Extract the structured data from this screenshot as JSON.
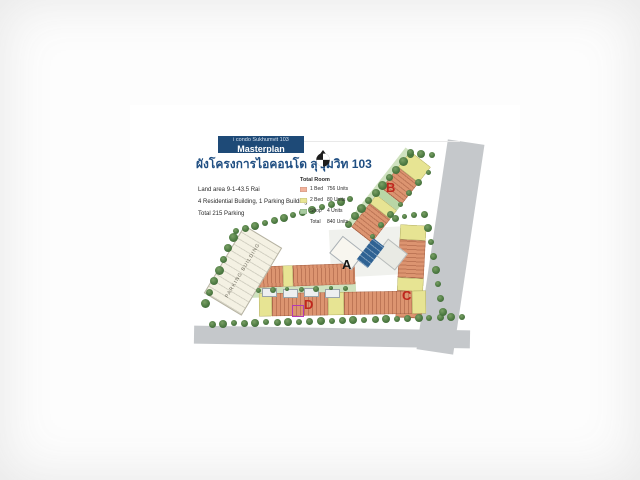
{
  "page": {
    "badge": {
      "project": "i condo Sukhumvit 103",
      "label": "Masterplan"
    },
    "title_thai": "ผังโครงการไอคอนโด สุขุมวิท 103",
    "info": {
      "land_area": "Land area 9-1-43.5 Rai",
      "buildings": "4 Residential Building, 1 Parking Building",
      "parking": "Total 215 Parking"
    },
    "legend": {
      "title": "Total Room",
      "rows": [
        {
          "label": "1 Bed",
          "value": "756 Units",
          "swatch": "#f2b29b"
        },
        {
          "label": "2 Bed",
          "value": "80 Units",
          "swatch": "#e9e694"
        },
        {
          "label": "Shop",
          "value": "4 Units",
          "swatch": "#a8cca0"
        },
        {
          "label": "Total",
          "value": "840 Units",
          "swatch": ""
        }
      ]
    },
    "plan": {
      "building_labels": {
        "a": "A",
        "b": "B",
        "c": "C",
        "d": "D"
      },
      "parking_label": "PARKING BUILDING",
      "north_icon": "north-arrow"
    },
    "colors": {
      "accent_blue": "#1e4a77",
      "title_blue": "#1f4e82",
      "building_salmon": "#dc9470",
      "unit_yellow": "#e7e493",
      "shop_green": "#a8cca0",
      "tree_green": "#4d7a42",
      "pool_blue": "#2f6293",
      "road_gray": "#c5c8cb",
      "label_red": "#c0261d",
      "marker_magenta": "#b23ab2"
    }
  }
}
